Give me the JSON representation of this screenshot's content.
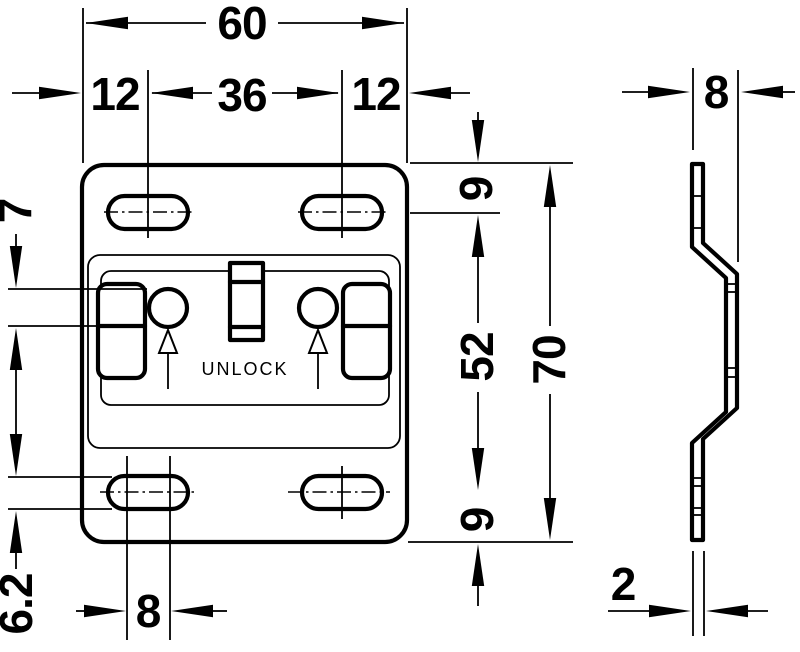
{
  "drawing": {
    "front_view": {
      "unlock_label": "UNLOCK",
      "dimensions": {
        "total_width": "60",
        "left_slot_offset": "12",
        "slot_center_distance": "36",
        "right_slot_offset": "12",
        "hole_diameter": "7",
        "slot_width": "6.2",
        "slot_length": "8",
        "top_edge_to_slot_center": "9",
        "slot_center_span": "52",
        "slot_center_to_bottom": "9",
        "total_height": "70"
      }
    },
    "side_view": {
      "dimensions": {
        "depth": "8",
        "thickness": "2"
      }
    },
    "colors": {
      "line": "#000000",
      "background": "#ffffff"
    }
  }
}
